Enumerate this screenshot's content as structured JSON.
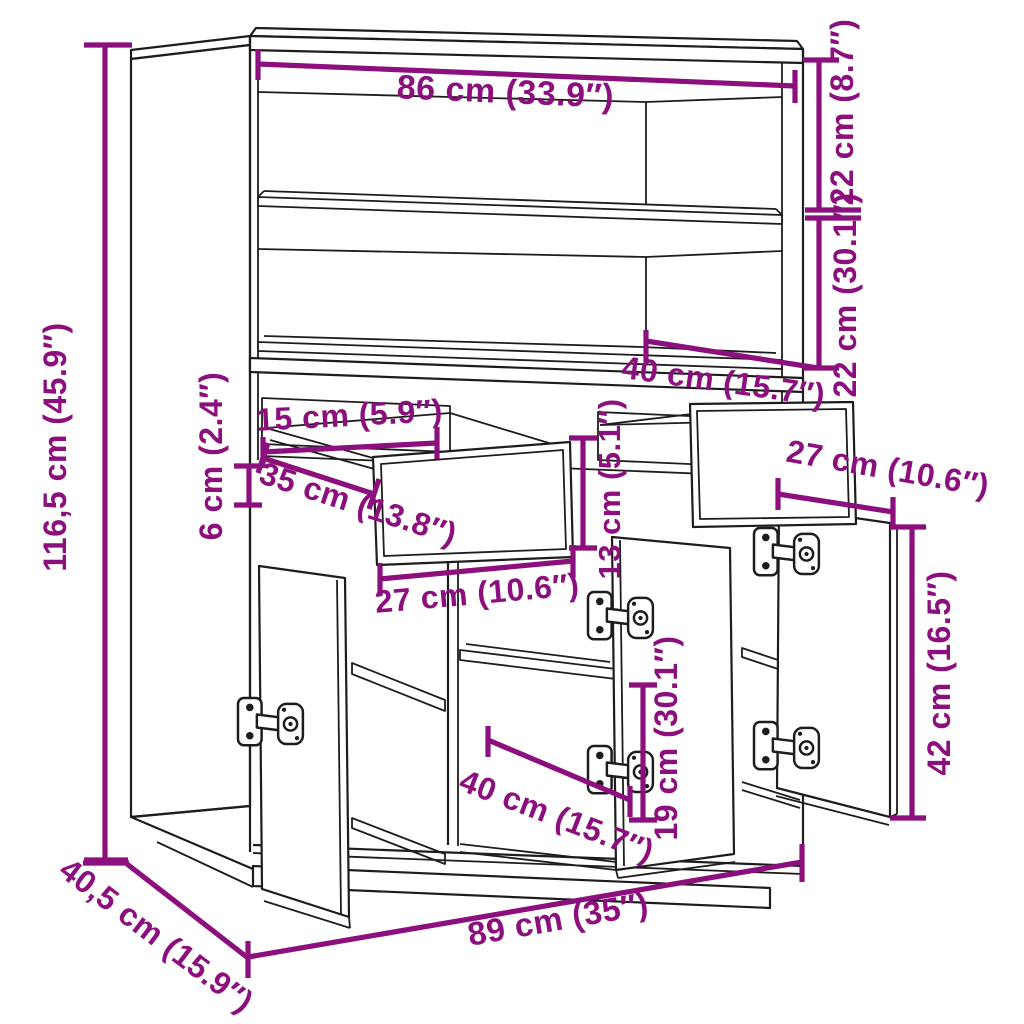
{
  "diagram": {
    "type": "furniture-dimension-diagram",
    "subject": "highboard cabinet with 2 drawers and 3 doors, two open top shelf compartments",
    "colors": {
      "dimension": "#8b0f7c",
      "line": "#1d1d1d",
      "background": "#ffffff"
    },
    "dimensions": [
      {
        "id": "top-width",
        "label": "86 cm (33.9″)"
      },
      {
        "id": "top-compartment-height",
        "label": "22 cm (8.7″)"
      },
      {
        "id": "second-compartment-height",
        "label": "22 cm (30.1″)"
      },
      {
        "id": "overall-height",
        "label": "116,5 cm (45.9″)"
      },
      {
        "id": "hutch-depth",
        "label": "40 cm (15.7″)"
      },
      {
        "id": "drawer-opening-height",
        "label": "15 cm (5.9″)"
      },
      {
        "id": "drawer-rail-height",
        "label": "6 cm (2.4″)"
      },
      {
        "id": "drawer-depth",
        "label": "35 cm (13.8″)"
      },
      {
        "id": "drawer-front-height",
        "label": "13 cm (5.1″)"
      },
      {
        "id": "drawer-width",
        "label": "27 cm (10.6″)"
      },
      {
        "id": "door-width",
        "label": "27 cm (10.6″)"
      },
      {
        "id": "door-height",
        "label": "42 cm (16.5″)"
      },
      {
        "id": "shelf-clearance",
        "label": "19 cm (30.1″)"
      },
      {
        "id": "bottom-interior-depth",
        "label": "40 cm (15.7″)"
      },
      {
        "id": "overall-width",
        "label": "89 cm (35″)"
      },
      {
        "id": "overall-depth",
        "label": "40,5 cm (15.9″)"
      }
    ]
  }
}
